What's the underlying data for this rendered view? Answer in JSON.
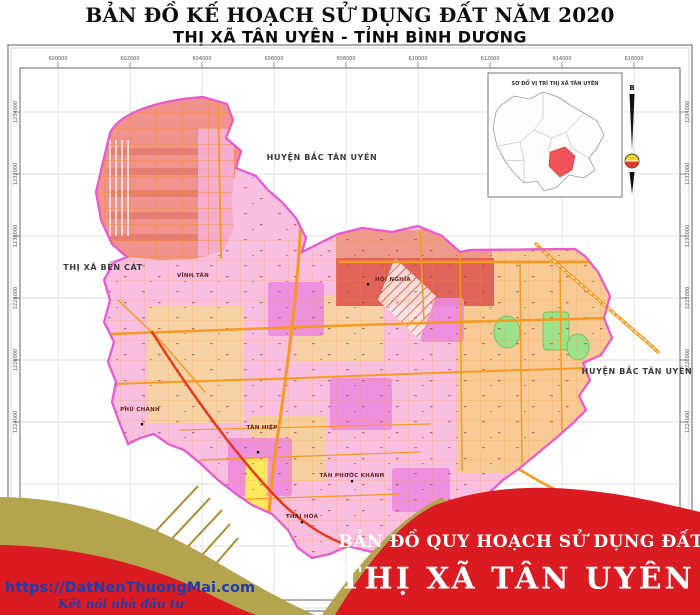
{
  "header": {
    "title_line1": "BẢN ĐỒ KẾ HOẠCH SỬ DỤNG ĐẤT NĂM 2020",
    "title_line2": "THỊ XÃ TÂN UYÊN - TỈNH BÌNH DƯƠNG"
  },
  "map": {
    "neighbor_labels": [
      {
        "text": "HUYỆN BẮC TÂN UYÊN"
      },
      {
        "text": "THỊ XÃ BẾN CÁT"
      },
      {
        "text": "HUYỆN BẮC TÂN UYÊN"
      }
    ],
    "place_labels": [
      {
        "text": "VĨNH TÂN"
      },
      {
        "text": "HỘI NGHĨA"
      },
      {
        "text": "PHÚ CHÁNH"
      },
      {
        "text": "TÂN HIỆP"
      },
      {
        "text": "TÂN PHƯỚC KHÁNH"
      },
      {
        "text": "THÁI HÒA"
      }
    ],
    "top_coords": [
      "600000",
      "602000",
      "604000",
      "606000",
      "608000",
      "610000",
      "612000",
      "614000",
      "616000"
    ],
    "side_coords": [
      "1234000",
      "1232000",
      "1230000",
      "1228000",
      "1226000",
      "1224000"
    ],
    "inset": {
      "title": "SƠ ĐỒ VỊ TRÍ THỊ XÃ TÂN UYÊN"
    },
    "north_label": "B"
  },
  "footer": {
    "website": "https://DatNenThuongMai.com",
    "tagline": "Kết nối nhà đầu tư",
    "banner_line1": "BẢN ĐỒ QUY HOẠCH SỬ DỤNG ĐẤT",
    "banner_line2": "THỊ XÃ TÂN UYÊN"
  },
  "colors": {
    "banner_red": "#da1c22",
    "ribbon_gold": "#b5a44e",
    "link_blue": "#1d3cae",
    "boundary_magenta": "#e959cf",
    "map_pink": "#f8bfe0",
    "road_orange": "#f59a23",
    "highway_red": "#e8391d",
    "industrial_salmon": "#f0938c",
    "plan_tan": "#f7c994",
    "green_park": "#9ce18b",
    "yellow_strip": "#ffe95c"
  }
}
